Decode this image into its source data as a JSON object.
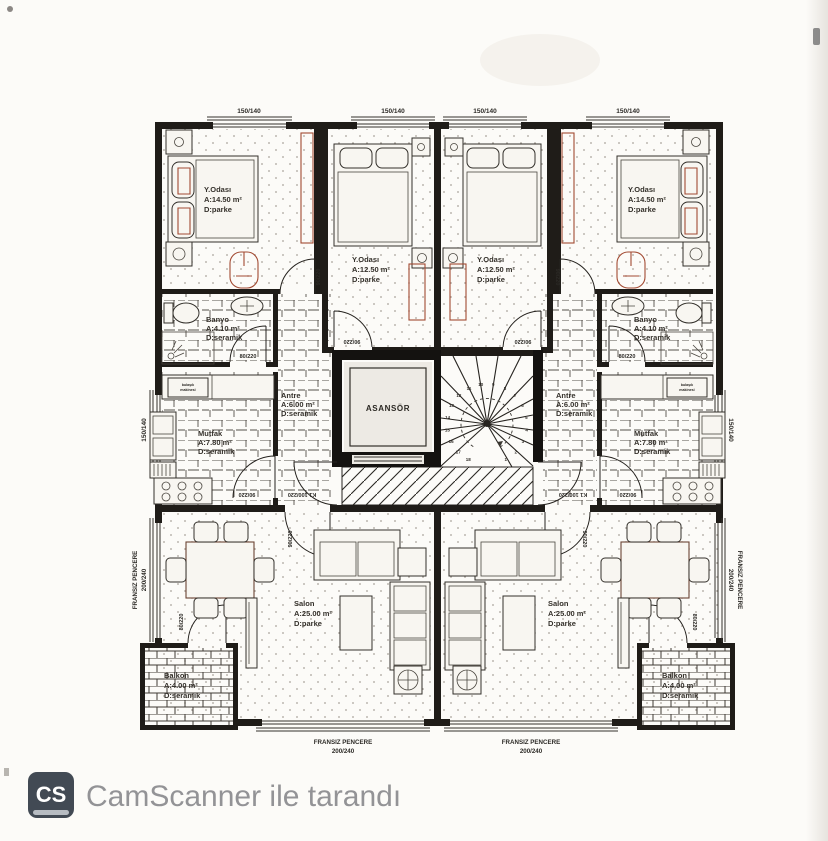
{
  "scan": {
    "footer": {
      "logo_text": "CS",
      "caption": "CamScanner ile tarandı"
    }
  },
  "plan": {
    "rooms": {
      "bed1": {
        "name": "Y.Odası",
        "area": "A:14.50 m²",
        "floor": "D:parke"
      },
      "bed2": {
        "name": "Y.Odası",
        "area": "A:12.50 m²",
        "floor": "D:parke"
      },
      "bed3": {
        "name": "Y.Odası",
        "area": "A:12.50 m²",
        "floor": "D:parke"
      },
      "bed4": {
        "name": "Y.Odası",
        "area": "A:14.50 m²",
        "floor": "D:parke"
      },
      "banyo_left": {
        "name": "Banyo",
        "area": "A:4.10 m²",
        "floor": "D:seramik"
      },
      "banyo_right": {
        "name": "Banyo",
        "area": "A:4.10 m²",
        "floor": "D:seramik"
      },
      "antre_left": {
        "name": "Antre",
        "area": "A:6.00 m²",
        "floor": "D:seramik"
      },
      "antre_right": {
        "name": "Antre",
        "area": "A:6.00 m²",
        "floor": "D:seramik"
      },
      "mutfak_left": {
        "name": "Mutfak",
        "area": "A:7.80 m²",
        "floor": "D:seramik"
      },
      "mutfak_right": {
        "name": "Mutfak",
        "area": "A:7.80 m²",
        "floor": "D:seramik"
      },
      "salon_left": {
        "name": "Salon",
        "area": "A:25.00 m²",
        "floor": "D:parke"
      },
      "salon_right": {
        "name": "Salon",
        "area": "A:25.00 m²",
        "floor": "D:parke"
      },
      "balkon_left": {
        "name": "Balkon",
        "area": "A:4.00 m²",
        "floor": "D:seramik"
      },
      "balkon_right": {
        "name": "Balkon",
        "area": "A:4.00 m²",
        "floor": "D:seramik"
      },
      "elevator": {
        "name": "ASANSÖR"
      }
    },
    "labels": {
      "window_top": "150/140",
      "window_side": "150/140",
      "door_standard": "90/220",
      "door_small": "80/220",
      "door_entry": "K1 100/220",
      "french_window_line1": "FRANSIZ PENCERE",
      "french_window_line2": "200/240",
      "appliance_line1": "bulaşık",
      "appliance_line2": "makinesi"
    },
    "stairs": {
      "numbers": [
        "1",
        "2",
        "3",
        "4",
        "5",
        "6",
        "7",
        "8",
        "9",
        "10",
        "11",
        "12",
        "13",
        "14",
        "15",
        "16",
        "17",
        "18"
      ]
    }
  },
  "colors": {
    "wall": "#1f1c18",
    "paper": "#fcfbf8",
    "accent_red": "#a24a32",
    "camscanner_gray": "#939396",
    "logo_bg": "#424a54"
  }
}
